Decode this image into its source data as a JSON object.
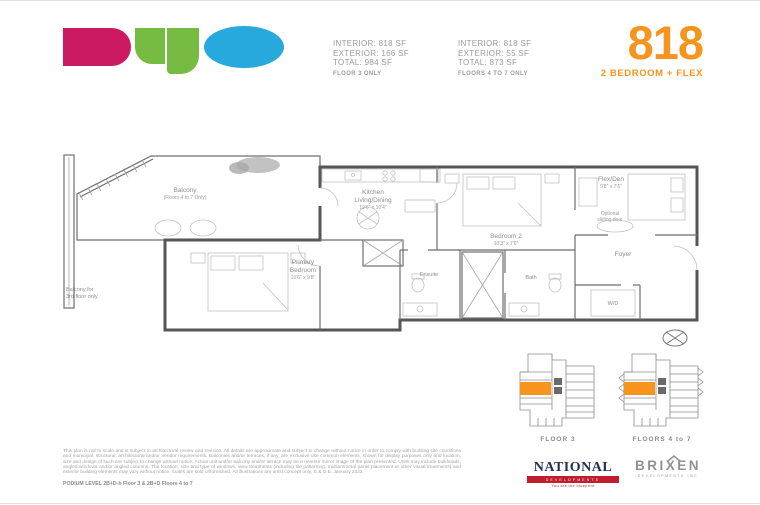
{
  "header": {
    "brand": "DUO",
    "logo_colors": {
      "d": "#CB1A62",
      "u": "#76BC43",
      "o": "#27A9DE"
    },
    "accent": "#F7941D",
    "specs": [
      {
        "interior": "INTERIOR: 818 SF",
        "exterior": "EXTERIOR: 166 SF",
        "total": "TOTAL: 984 SF",
        "floors": "FLOOR 3 ONLY"
      },
      {
        "interior": "INTERIOR: 818 SF",
        "exterior": "EXTERIOR: 55 SF",
        "total": "TOTAL: 873 SF",
        "floors": "FLOORS 4 TO 7 ONLY"
      }
    ],
    "unit_number": "818",
    "unit_type": "2 BEDROOM + FLEX"
  },
  "plan": {
    "balcony": {
      "label": "Balcony",
      "note": "(Floors 4 to 7 Only)"
    },
    "balcony_side_note": {
      "line1": "Balcony for",
      "line2": "3rd floor only"
    },
    "kitchen": {
      "line1": "Kitchen",
      "line2": "Living/Dining",
      "dims": "19'6\" x 10'4\""
    },
    "primary": {
      "line1": "Primary",
      "line2": "Bedroom",
      "dims": "10'6\" x 9'8\""
    },
    "bedroom2": {
      "label": "Bedroom 2",
      "dims": "10'3\" x 7'6\""
    },
    "flex": {
      "label": "Flex/Den",
      "dims": "9'8\" x 7'6\""
    },
    "optional": {
      "line1": "Optional",
      "line2": "sliding door"
    },
    "foyer": "Foyer",
    "ensuite": "Ensuite",
    "bath": "Bath",
    "wd": "W/D"
  },
  "keyplans": [
    {
      "label": "FLOOR 3",
      "highlight_color": "#F7941D"
    },
    {
      "label": "FLOORS 4 to 7",
      "highlight_color": "#F7941D"
    }
  ],
  "footer": {
    "disclaimer": "This plan is not to scale and is subject to architectural review and revision. All details are approximate and subject to change without notice in order to comply with building site conditions and municipal, structural, architectural and/or Vendor requirements. Balconies and/or terraces, if any, are exclusive use common elements, shown for display purposes only and location, size and design of such are subject to change without notice. Actual unit and/or balcony and/or terrace may be a reverse mirror image of the plan presented. Units may include bulkheads, angled windows and/or angled columns. The location, size and type of windows, view treatments (including tile patterning, mullion/metal panel placement or other visual treatments) and exterior building elements may vary without notice. Suites are sold unfurnished. All illustrations are artist concept only. E.& O.E. January 2022.",
    "podium_note": "PODIUM LEVEL 2B+D-b Floor 3 & 2B+D Floors 4 to 7",
    "national": {
      "name": "NATIONAL",
      "band": "DEVELOPMENTS",
      "tagline": "You are the blueprint"
    },
    "brixen": {
      "name": "BRIXEN",
      "sub": "DEVELOPMENTS INC"
    }
  }
}
